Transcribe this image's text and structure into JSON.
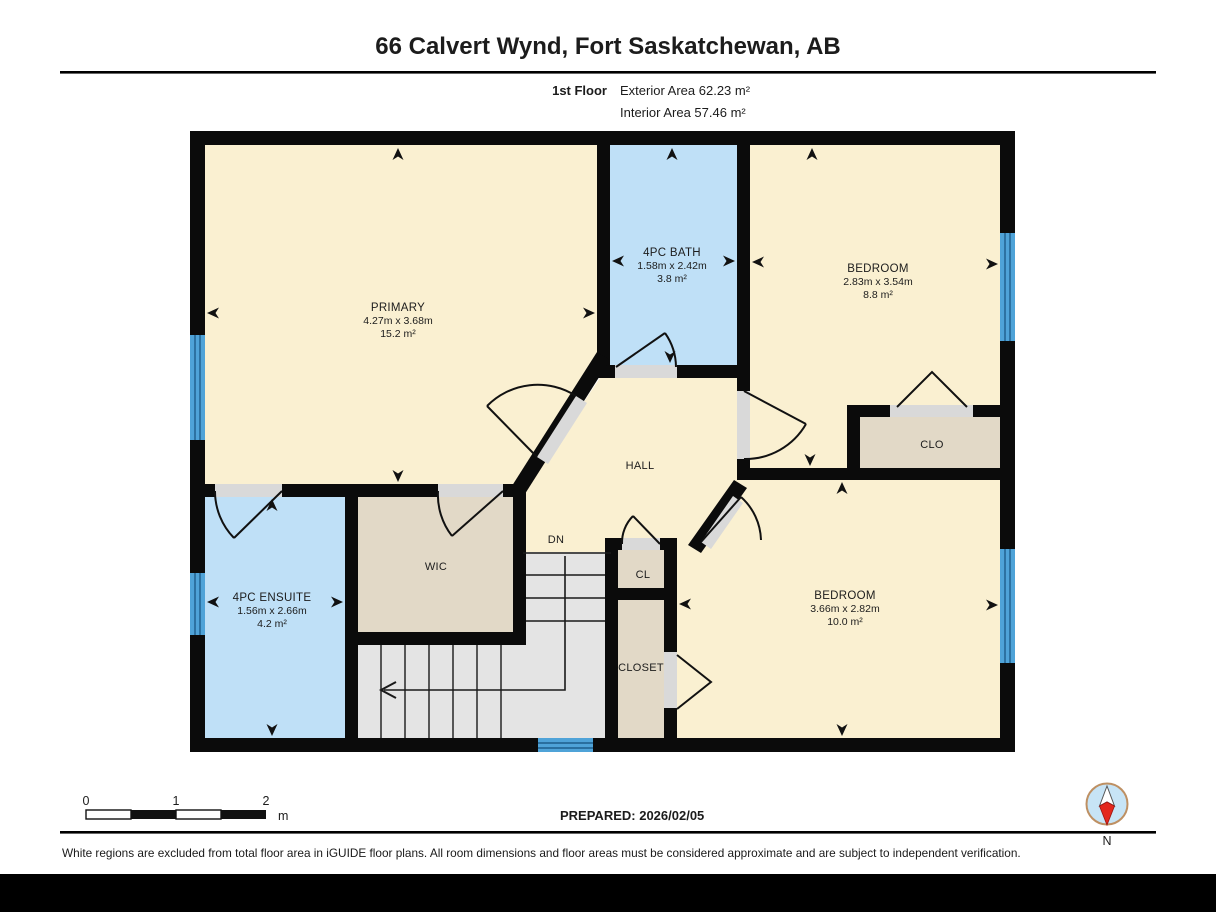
{
  "header": {
    "title": "66 Calvert Wynd, Fort Saskatchewan, AB",
    "floor_label": "1st Floor",
    "exterior_area": "Exterior Area 62.23 m²",
    "interior_area": "Interior Area 57.46 m²"
  },
  "rooms": {
    "primary": {
      "name": "PRIMARY",
      "dims": "4.27m x 3.68m",
      "area": "15.2 m²"
    },
    "bath": {
      "name": "4PC BATH",
      "dims": "1.58m x 2.42m",
      "area": "3.8 m²"
    },
    "bedroom1": {
      "name": "BEDROOM",
      "dims": "2.83m x 3.54m",
      "area": "8.8 m²"
    },
    "ensuite": {
      "name": "4PC ENSUITE",
      "dims": "1.56m x 2.66m",
      "area": "4.2 m²"
    },
    "bedroom2": {
      "name": "BEDROOM",
      "dims": "3.66m x 2.82m",
      "area": "10.0 m²"
    },
    "hall": "HALL",
    "wic": "WIC",
    "clo": "CLO",
    "cl": "CL",
    "closet": "CLOSET",
    "stairs_dn": "DN"
  },
  "scale_bar": {
    "tick0": "0",
    "tick1": "1",
    "tick2": "2",
    "unit": "m"
  },
  "prepared_label": "PREPARED: 2026/02/05",
  "compass_label": "N",
  "disclaimer": "White regions are excluded from total floor area in iGUIDE floor plans. All room dimensions and floor areas must be considered approximate and are subject to independent verification.",
  "colors": {
    "room_fill": "#FAF0D1",
    "wet_room_fill": "#BFE0F7",
    "closet_fill": "#E2D9C7",
    "stairs_fill": "#E4E4E4",
    "wall": "#0b0b0b",
    "window": "#4FA3D8",
    "door_sill": "#D9D9D9",
    "compass_red": "#E3271D",
    "compass_face": "#C7E4F6"
  }
}
